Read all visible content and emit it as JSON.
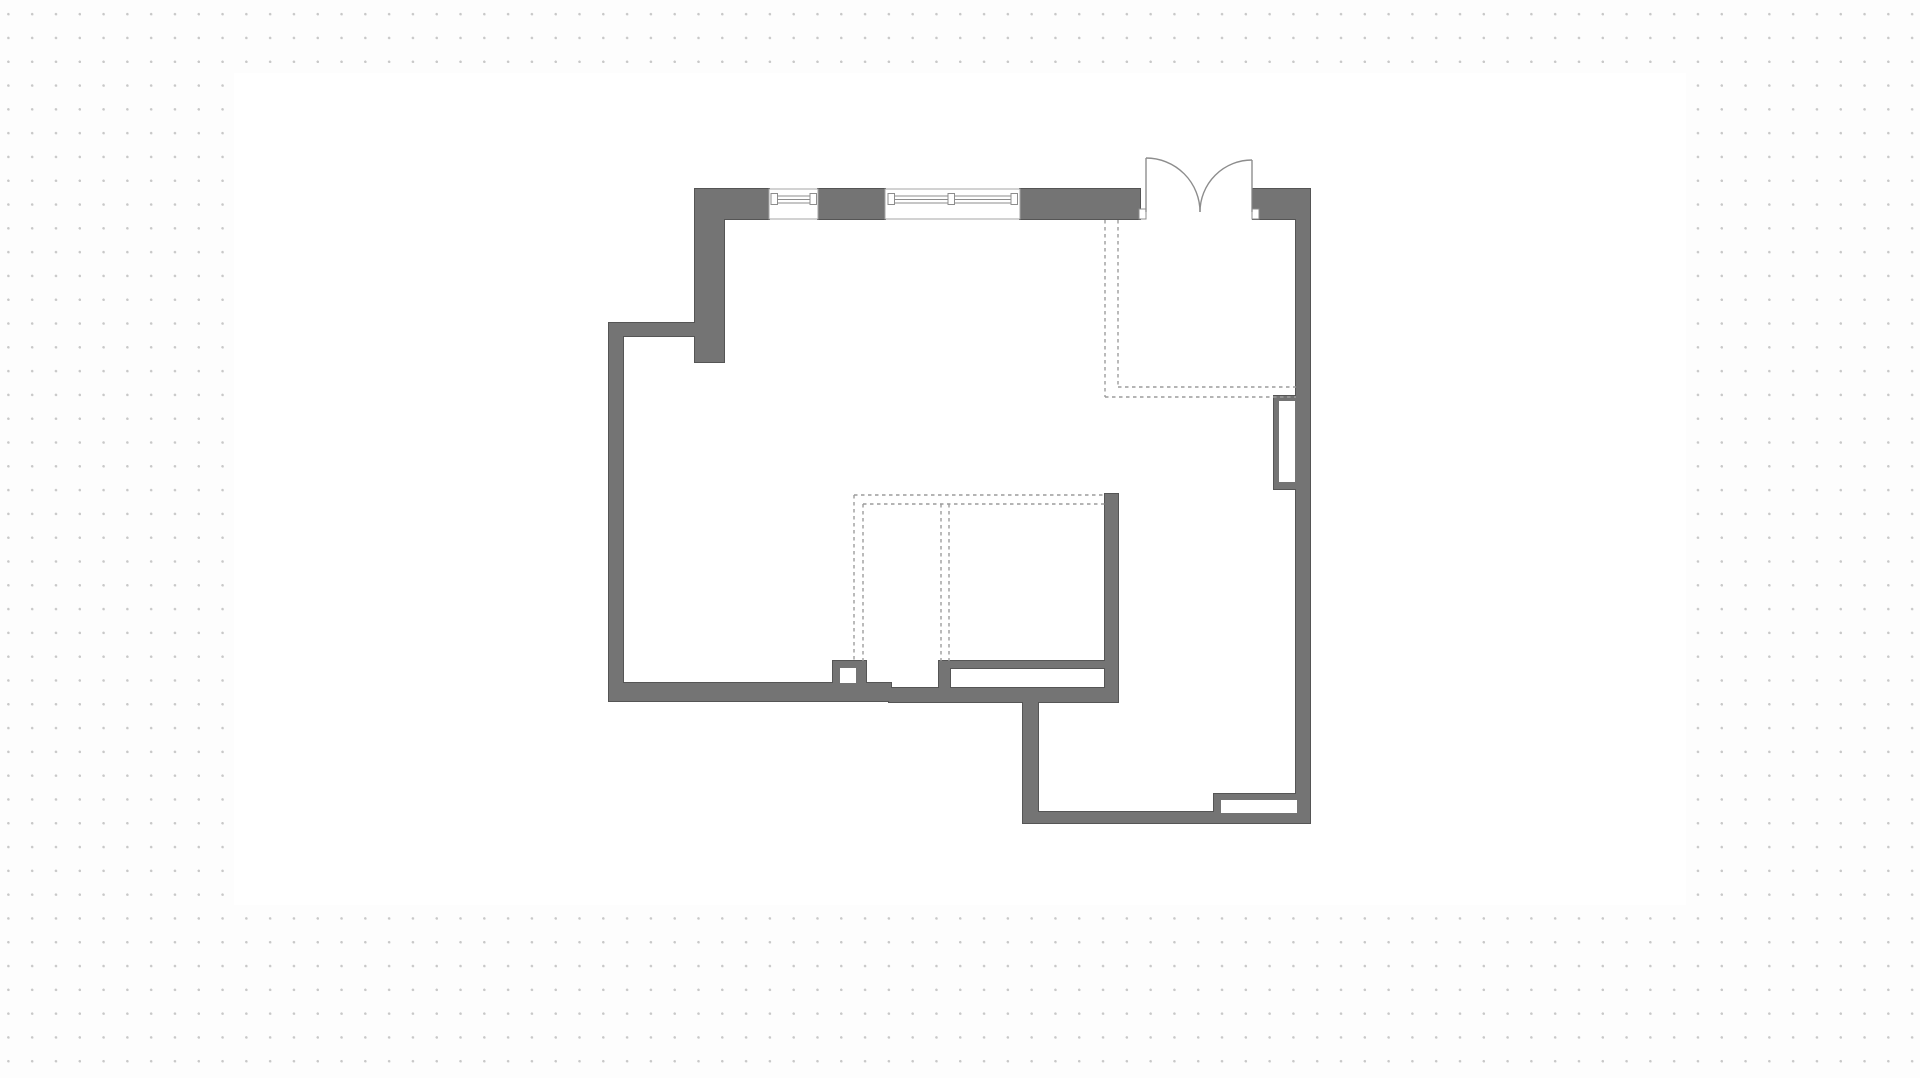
{
  "palette": {
    "page_background": "#fdfdfd",
    "dot_color": "#c8c8c8",
    "artboard_fill": "#ffffff",
    "wall_fill": "#747474",
    "wall_edge": "#555555",
    "frame_line": "#8d8d8d",
    "frame_light": "#a6a6a6",
    "dash_line": "#9c9c9c"
  },
  "grid": {
    "dot_spacing_px": 23.8,
    "dot_size_px": 2.5
  },
  "floorplan": {
    "artboard": {
      "x": 234,
      "y": 73,
      "w": 1452,
      "h": 832
    },
    "walls": [
      {
        "id": "top-wall-left",
        "x": 695,
        "y": 189,
        "w": 74,
        "h": 30
      },
      {
        "id": "top-wall-mid",
        "x": 818,
        "y": 189,
        "w": 67,
        "h": 30
      },
      {
        "id": "top-wall-right",
        "x": 1020,
        "y": 189,
        "w": 120,
        "h": 30
      },
      {
        "id": "top-wall-entry-right",
        "x": 1253,
        "y": 189,
        "w": 57,
        "h": 30
      },
      {
        "id": "right-wall",
        "x": 1296,
        "y": 217,
        "w": 14,
        "h": 606
      },
      {
        "id": "upper-left-wall",
        "x": 695,
        "y": 189,
        "w": 29,
        "h": 173
      },
      {
        "id": "step-wall",
        "x": 609,
        "y": 323,
        "w": 91,
        "h": 13
      },
      {
        "id": "left-wall",
        "x": 609,
        "y": 323,
        "w": 14,
        "h": 378
      },
      {
        "id": "bottom-wall-west",
        "x": 609,
        "y": 683,
        "w": 282,
        "h": 18
      },
      {
        "id": "bottom-wall-east",
        "x": 889,
        "y": 688,
        "w": 229,
        "h": 14
      },
      {
        "id": "mid-partition-wall",
        "x": 1105,
        "y": 494,
        "w": 13,
        "h": 208
      },
      {
        "id": "pocket-wall-top",
        "x": 941,
        "y": 661,
        "w": 166,
        "h": 7
      },
      {
        "id": "pocket-wall-cap",
        "x": 939,
        "y": 661,
        "w": 11,
        "h": 41
      },
      {
        "id": "lower-room-left-wall",
        "x": 1023,
        "y": 700,
        "w": 15,
        "h": 122
      },
      {
        "id": "lower-room-bottom-wall",
        "x": 1023,
        "y": 812,
        "w": 287,
        "h": 11
      },
      {
        "id": "pillar",
        "x": 833,
        "y": 661,
        "w": 33,
        "h": 28
      },
      {
        "id": "right-wall-niche",
        "x": 1274,
        "y": 396,
        "w": 24,
        "h": 93
      },
      {
        "id": "bottom-sill-niche",
        "x": 1214,
        "y": 794,
        "w": 84,
        "h": 20
      }
    ],
    "cutouts": [
      {
        "id": "pillar-hollow",
        "x": 840,
        "y": 668,
        "w": 16,
        "h": 15
      },
      {
        "id": "right-wall-niche-hollow",
        "x": 1279,
        "y": 401,
        "w": 16,
        "h": 81
      },
      {
        "id": "bottom-sill-niche-hollow",
        "x": 1221,
        "y": 800,
        "w": 76,
        "h": 13
      }
    ],
    "windows": [
      {
        "id": "window-small",
        "x": 769,
        "y": 189,
        "w": 49,
        "h": 30,
        "bar": {
          "x1": 771,
          "x2": 816,
          "y": 196,
          "h": 7
        },
        "caps": [
          771,
          810
        ],
        "cap_y": 193.5,
        "cap_w": 6.5,
        "cap_h": 11
      },
      {
        "id": "window-wide",
        "x": 885,
        "y": 189,
        "w": 135,
        "h": 30,
        "bar": {
          "x1": 888,
          "x2": 1017,
          "y": 196,
          "h": 7
        },
        "caps": [
          888,
          948,
          1011
        ],
        "cap_y": 193.5,
        "cap_w": 6.5,
        "cap_h": 11
      }
    ],
    "door": {
      "type": "double-swing-entry",
      "jambs": [
        {
          "x": 1139,
          "y": 209,
          "w": 7,
          "h": 10
        },
        {
          "x": 1252,
          "y": 209,
          "w": 7,
          "h": 10
        }
      ],
      "leaves": [
        {
          "hinge_x": 1146,
          "hinge_y": 212,
          "tip_y": 158,
          "radius": 54,
          "sweep": 1,
          "end_x": 1200,
          "end_y": 212
        },
        {
          "hinge_x": 1252,
          "hinge_y": 212,
          "tip_y": 160,
          "radius": 52,
          "sweep": 0,
          "end_x": 1200,
          "end_y": 212
        }
      ]
    },
    "dashed_lines": [
      {
        "x1": 1105,
        "y1": 220,
        "x2": 1105,
        "y2": 397
      },
      {
        "x1": 1118,
        "y1": 220,
        "x2": 1118,
        "y2": 387
      },
      {
        "x1": 1118,
        "y1": 387,
        "x2": 1296,
        "y2": 387
      },
      {
        "x1": 1105,
        "y1": 397,
        "x2": 1296,
        "y2": 397
      },
      {
        "x1": 854,
        "y1": 495,
        "x2": 1105,
        "y2": 495
      },
      {
        "x1": 863,
        "y1": 504,
        "x2": 1105,
        "y2": 504
      },
      {
        "x1": 854,
        "y1": 495,
        "x2": 854,
        "y2": 661
      },
      {
        "x1": 863,
        "y1": 504,
        "x2": 863,
        "y2": 661
      },
      {
        "x1": 941,
        "y1": 504,
        "x2": 941,
        "y2": 661
      },
      {
        "x1": 949,
        "y1": 504,
        "x2": 949,
        "y2": 661
      }
    ]
  }
}
